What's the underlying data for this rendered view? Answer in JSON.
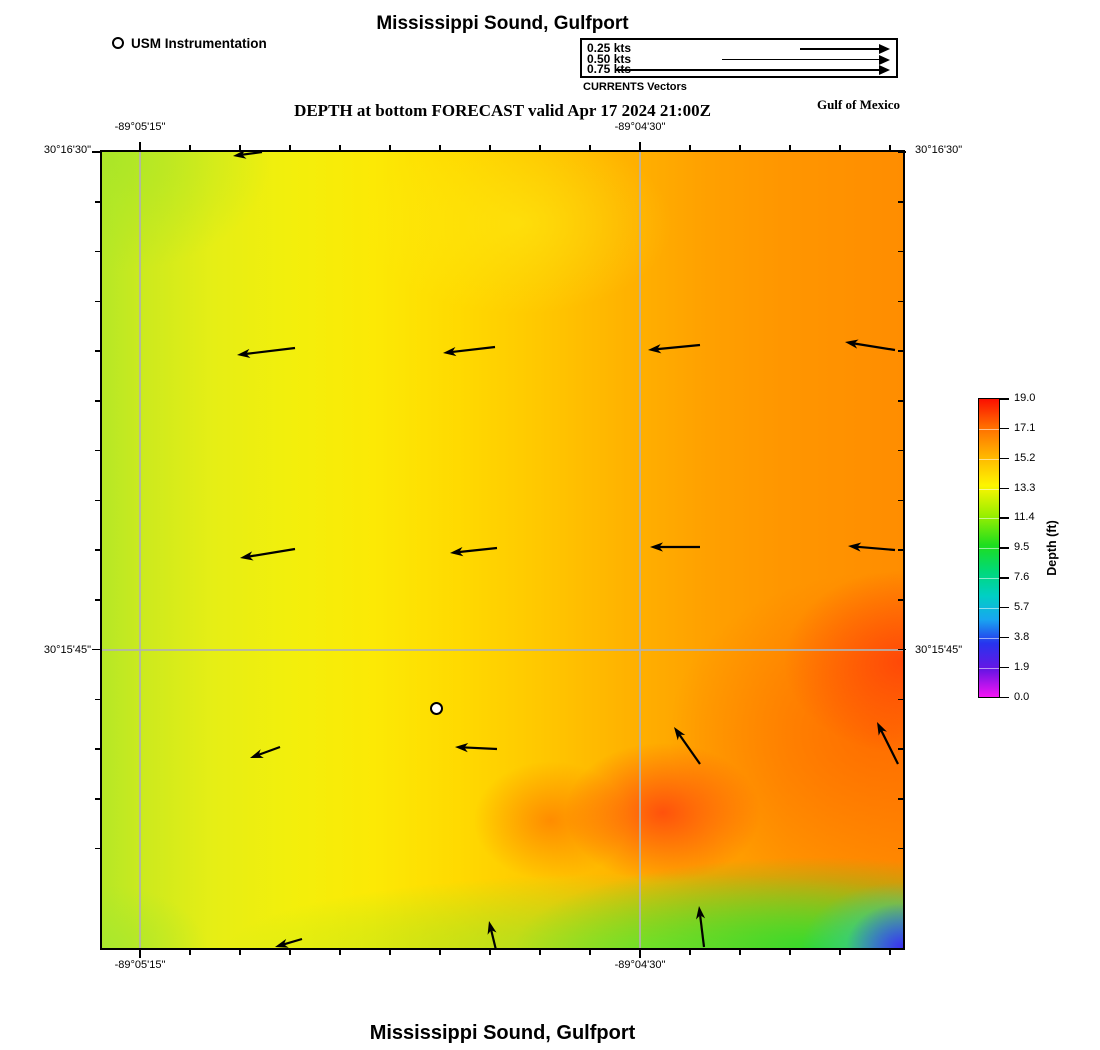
{
  "page": {
    "title_top": "Mississippi Sound, Gulfport",
    "subtitle": "DEPTH at bottom FORECAST valid Apr 17 2024 21:00Z",
    "region_label": "Gulf of Mexico",
    "title_bottom": "Mississippi Sound, Gulfport"
  },
  "station_legend": {
    "label": "USM Instrumentation"
  },
  "vectors_legend": {
    "caption": "CURRENTS Vectors",
    "items": [
      {
        "label": "0.25 kts",
        "line_px": 90
      },
      {
        "label": "0.50 kts",
        "line_px": 168
      },
      {
        "label": "0.75 kts",
        "line_px": 274
      }
    ]
  },
  "axes": {
    "lon_labels": [
      "-89°05'15\"",
      "-89°04'30\""
    ],
    "lat_labels": [
      "30°16'30\"",
      "30°15'45\""
    ]
  },
  "colorbar": {
    "title": "Depth (ft)",
    "tick_labels": [
      "19.0",
      "17.1",
      "15.2",
      "13.3",
      "11.4",
      "9.5",
      "7.6",
      "5.7",
      "3.8",
      "1.9",
      "0.0"
    ],
    "gradient": [
      {
        "pos": 0,
        "color": "#fb0f00"
      },
      {
        "pos": 9,
        "color": "#ff6a00"
      },
      {
        "pos": 19,
        "color": "#ffb400"
      },
      {
        "pos": 29,
        "color": "#fdf500"
      },
      {
        "pos": 39,
        "color": "#9aef00"
      },
      {
        "pos": 49,
        "color": "#1ede1e"
      },
      {
        "pos": 58,
        "color": "#00d97a"
      },
      {
        "pos": 66,
        "color": "#00cfc4"
      },
      {
        "pos": 74,
        "color": "#18a6f0"
      },
      {
        "pos": 82,
        "color": "#2734ee"
      },
      {
        "pos": 91,
        "color": "#6a14e4"
      },
      {
        "pos": 100,
        "color": "#f414f4"
      }
    ]
  },
  "chart_data": {
    "type": "heatmap",
    "title": "Mississippi Sound, Gulfport",
    "subtitle": "DEPTH at bottom FORECAST valid Apr 17 2024 21:00Z",
    "variable": "Depth (ft)",
    "colorbar_range": [
      0.0,
      19.0
    ],
    "colorbar_ticks": [
      19.0,
      17.1,
      15.2,
      13.3,
      11.4,
      9.5,
      7.6,
      5.7,
      3.8,
      1.9,
      0.0
    ],
    "x_axis": {
      "labels": [
        "-89°05'15\"",
        "-89°04'30\""
      ],
      "gridlines": true
    },
    "y_axis": {
      "labels": [
        "30°16'30\"",
        "30°15'45\""
      ],
      "gridlines": true
    },
    "field_summary": [
      {
        "area": "west side",
        "approx_depth_ft": 14.5,
        "color": "#d9ec1e"
      },
      {
        "area": "center",
        "approx_depth_ft": 15.5,
        "color": "#ffd400"
      },
      {
        "area": "east side",
        "approx_depth_ft": 17.5,
        "color": "#ff9000"
      },
      {
        "area": "east edge / south-central patches",
        "approx_depth_ft": 18.5,
        "color": "#ff4a10"
      },
      {
        "area": "south edge east half",
        "approx_depth_ft": 12.0,
        "color": "#3ddd3d"
      },
      {
        "area": "southeast corner",
        "approx_depth_ft": 3.5,
        "color": "#3c2df0"
      }
    ],
    "vector_scale_note": "legend arrow of 90 px = 0.25 kts",
    "vectors": [
      [
        160,
        0,
        131,
        4
      ],
      [
        193,
        196,
        135,
        203
      ],
      [
        393,
        195,
        341,
        201
      ],
      [
        598,
        193,
        546,
        198
      ],
      [
        793,
        198,
        743,
        190
      ],
      [
        193,
        397,
        138,
        406
      ],
      [
        395,
        396,
        348,
        401
      ],
      [
        598,
        395,
        548,
        395
      ],
      [
        793,
        398,
        746,
        394
      ],
      [
        178,
        595,
        148,
        606
      ],
      [
        395,
        597,
        353,
        595
      ],
      [
        598,
        612,
        572,
        575
      ],
      [
        796,
        612,
        775,
        570
      ],
      [
        200,
        787,
        173,
        795
      ],
      [
        394,
        798,
        387,
        769
      ],
      [
        602,
        795,
        597,
        754
      ]
    ],
    "station": {
      "label": "USM Instrumentation",
      "x_px": 335,
      "y_px": 557
    }
  }
}
